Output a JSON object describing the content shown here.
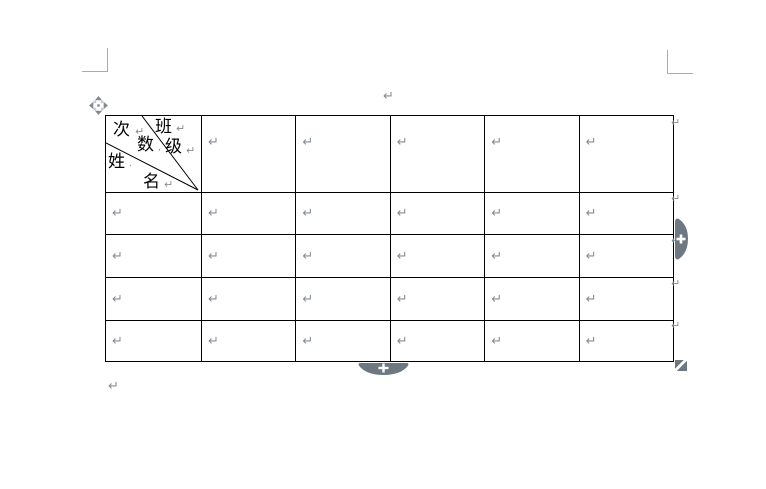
{
  "page": {
    "background": "#ffffff",
    "kind": "word-processor page with empty 6x5 table"
  },
  "colors": {
    "table_border": "#000000",
    "formatting_mark": "#868e96",
    "crop_mark": "#a8acb0",
    "handle_fill": "#6e7883",
    "handle_plus": "#ffffff"
  },
  "marks": {
    "paragraph_above_table": "↵",
    "paragraph_below_table": "↵"
  },
  "icons": {
    "move_handle": "table-move-cross-arrows",
    "insert_column_handle": "plus",
    "insert_row_handle": "plus",
    "resize_handle": "diagonal-split-square"
  },
  "table": {
    "rows": 5,
    "cols": 6,
    "cell_mark": "↵",
    "row_end_mark": "↵",
    "header_cell": {
      "description": "diagonal three-way slash header",
      "labels": [
        {
          "text": "次",
          "mark": "↵"
        },
        {
          "text": "班",
          "mark": "↵"
        },
        {
          "text": "数",
          "mark": ","
        },
        {
          "text": "级",
          "mark": "↵"
        },
        {
          "text": "姓",
          "mark": "."
        },
        {
          "text": "名",
          "mark": "↵"
        }
      ]
    }
  }
}
